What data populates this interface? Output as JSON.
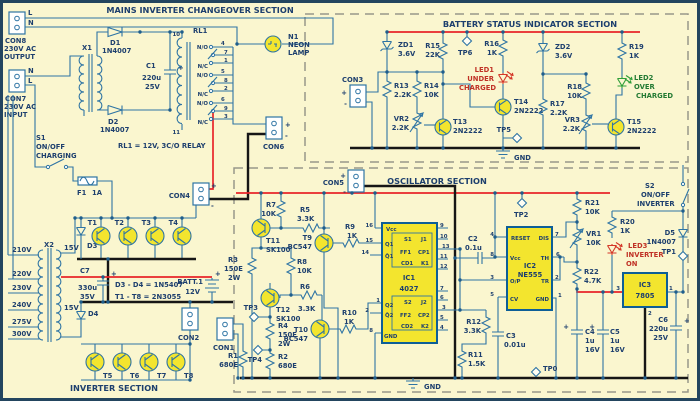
{
  "sym": {
    "plus": "+",
    "minus": "-"
  },
  "mains": {
    "title": "MAINS INVERTER CHANGEOVER SECTION",
    "con8": {
      "name": "CON8",
      "l1": "230V AC",
      "l2": "OUTPUT",
      "t1": "L",
      "t2": "N"
    },
    "con7": {
      "name": "CON7",
      "l1": "230V AC",
      "l2": "INPUT",
      "t1": "N",
      "t2": "L"
    },
    "x1": "X1",
    "d1": {
      "name": "D1",
      "val": "1N4007"
    },
    "d2": {
      "name": "D2",
      "val": "1N4007"
    },
    "c1": {
      "name": "C1",
      "v1": "220u",
      "v2": "25V"
    },
    "rl1": {
      "name": "RL1",
      "pin_top": "10",
      "pin_bot": "11",
      "no": "N/O",
      "nc": "N/C",
      "pins": [
        "4",
        "7",
        "1",
        "5",
        "8",
        "2",
        "6",
        "9",
        "3"
      ],
      "note": "RL1 = 12V, 3C/O RELAY"
    },
    "n1": {
      "name": "N1",
      "l1": "NEON",
      "l2": "LAMP"
    },
    "s1": {
      "name": "S1",
      "l1": "ON/OFF",
      "l2": "CHARGING"
    },
    "f1": {
      "name": "F1",
      "val": "1A"
    },
    "con6": "CON6",
    "con4": "CON4"
  },
  "inverter": {
    "title": "INVERTER SECTION",
    "x2": {
      "name": "X2",
      "taps_left": [
        "210V",
        "220V",
        "230V",
        "240V",
        "275V",
        "300V"
      ],
      "taps_right": [
        "15V",
        "15V"
      ]
    },
    "c7": {
      "name": "C7",
      "v1": "330u",
      "v2": "35V"
    },
    "d3": "D3",
    "d4": "D4",
    "t": [
      "T1",
      "T2",
      "T3",
      "T4",
      "T5",
      "T6",
      "T7",
      "T8"
    ],
    "note_d": "D3 - D4 = 1N5407",
    "note_t": "T1 - T8 = 2N3055",
    "batt": {
      "name": "BATT.1",
      "val": "12V"
    },
    "con2": "CON2"
  },
  "battery": {
    "title": "BATTERY STATUS INDICATOR SECTION",
    "con3": "CON3",
    "zd1": {
      "name": "ZD1",
      "val": "3.6V"
    },
    "zd2": {
      "name": "ZD2",
      "val": "3.6V"
    },
    "r13": {
      "name": "R13",
      "val": "2.2K"
    },
    "r14": {
      "name": "R14",
      "val": "10K"
    },
    "r15": {
      "name": "R15",
      "val": "22K"
    },
    "r16": {
      "name": "R16",
      "val": "1K"
    },
    "r17": {
      "name": "R17",
      "val": "2.2K"
    },
    "r18": {
      "name": "R18",
      "val": "10K"
    },
    "r19": {
      "name": "R19",
      "val": "1K"
    },
    "vr2": {
      "name": "VR2",
      "val": "2.2K"
    },
    "vr3": {
      "name": "VR3",
      "val": "2.2K"
    },
    "t13": {
      "name": "T13",
      "val": "2N2222"
    },
    "t14": {
      "name": "T14",
      "val": "2N2222"
    },
    "t15": {
      "name": "T15",
      "val": "2N2222"
    },
    "led1": {
      "name": "LED1",
      "l1": "UNDER",
      "l2": "CHARGED"
    },
    "led2": {
      "name": "LED2",
      "l1": "OVER",
      "l2": "CHARGED"
    },
    "tp5": "TP5",
    "tp6": "TP6",
    "gnd": "GND"
  },
  "osc": {
    "title": "OSCILLATOR SECTION",
    "con5": "CON5",
    "con1": "CON1",
    "r1": {
      "name": "R1",
      "val": "680E"
    },
    "r2": {
      "name": "R2",
      "val": "680E"
    },
    "r3": {
      "name": "R3",
      "val": "150E",
      "val2": "2W"
    },
    "r4": {
      "name": "R4",
      "val": "150E",
      "val2": "2W"
    },
    "r5": {
      "name": "R5",
      "val": "3.3K"
    },
    "r6": {
      "name": "R6",
      "val": "3.3K"
    },
    "r7": {
      "name": "R7",
      "val": "10K"
    },
    "r8": {
      "name": "R8",
      "val": "10K"
    },
    "r9": {
      "name": "R9",
      "val": "1K"
    },
    "r10": {
      "name": "R10",
      "val": "1K"
    },
    "r11": {
      "name": "R11",
      "val": "1.5K"
    },
    "r12": {
      "name": "R12",
      "val": "3.3K"
    },
    "r20": {
      "name": "R20",
      "val": "1K"
    },
    "r21": {
      "name": "R21",
      "val": "10K"
    },
    "r22": {
      "name": "R22",
      "val": "4.7K"
    },
    "vr1": {
      "name": "VR1",
      "val": "10K"
    },
    "t9": {
      "name": "T9",
      "val": "BC547"
    },
    "t10": {
      "name": "T10",
      "val": "BC547"
    },
    "t11": {
      "name": "T11",
      "val": "SK100"
    },
    "t12": {
      "name": "T12",
      "val": "SK100"
    },
    "c2": {
      "name": "C2",
      "v1": "0.1u"
    },
    "c3": {
      "name": "C3",
      "v1": "0.01u"
    },
    "c4": {
      "name": "C4",
      "v1": "1u",
      "v2": "16V"
    },
    "c5": {
      "name": "C5",
      "v1": "1u",
      "v2": "16V"
    },
    "c6": {
      "name": "C6",
      "v1": "220u",
      "v2": "25V"
    },
    "d5": {
      "name": "D5",
      "val": "1N4007"
    },
    "s2": {
      "name": "S2",
      "l1": "ON/OFF",
      "l2": "INVERTER"
    },
    "led3": {
      "name": "LED3",
      "l1": "INVERTER",
      "l2": "ON"
    },
    "ic1": {
      "name": "IC1",
      "part": "4027",
      "vcc": "Vcc",
      "gnd": "GND",
      "q1": "Q1",
      "q1b": "Q̄1",
      "q2": "Q2",
      "q2b": "Q̄2",
      "ff1": {
        "s": "S1",
        "j": "J1",
        "ff": "FF1",
        "cp": "CP1",
        "cd": "CD1",
        "k": "K1"
      },
      "ff2": {
        "s": "S2",
        "j": "J2",
        "ff": "FF2",
        "cp": "CP2",
        "cd": "CD2",
        "k": "K2"
      },
      "pins_left": [
        "16",
        "15",
        "14",
        "1",
        "2",
        "8"
      ],
      "pins_right": [
        "9",
        "10",
        "13",
        "11",
        "12",
        "7",
        "6",
        "3",
        "5",
        "4"
      ]
    },
    "ic2": {
      "name": "IC2",
      "part": "NE555",
      "reset": "RESET",
      "vcc": "Vcc",
      "op": "O/P",
      "cv": "CV",
      "dis": "DIS",
      "th": "TH",
      "tr": "TR",
      "gnd": "GND",
      "pins_left": [
        "4",
        "8",
        "3",
        "5"
      ],
      "pins_right": [
        "7",
        "6",
        "2",
        "1"
      ]
    },
    "ic3": {
      "name": "IC3",
      "part": "7805",
      "pins": [
        "3",
        "1",
        "2"
      ]
    },
    "tp0": "TP0",
    "tp1": "TP1",
    "tp2": "TP2",
    "tp3": "TP3",
    "tp4": "TP4",
    "gnd": "GND"
  }
}
